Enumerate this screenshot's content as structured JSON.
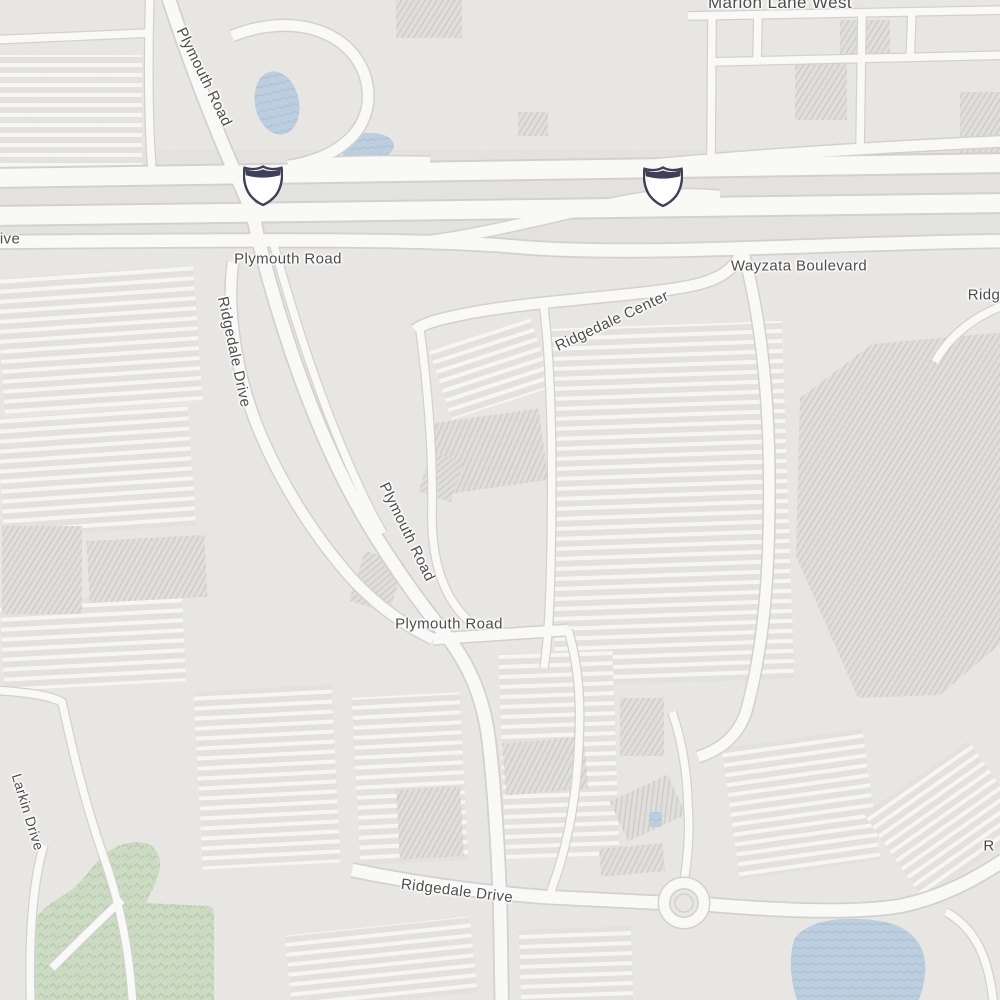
{
  "map": {
    "colors": {
      "background": "#e9e8e5",
      "road_fill": "#fbfbfa",
      "road_casing": "#d3d2cf",
      "freeway_corridor": "#e4e3e0",
      "water": "#bccfe0",
      "water_wave_line": "#aac2d6",
      "park": "#cddcc4",
      "park_tree": "#b6cba9",
      "building": "#e1e0dd",
      "building_hatch": "#cfcecb",
      "parking_base": "#e4e3e0",
      "parking_row": "#f8f8f6",
      "label": "#4d4d4d",
      "label_halo": "#ffffff",
      "shield_fill": "#ffffff",
      "shield_border": "#3f3f55"
    },
    "labels": [
      {
        "id": "marion-lane-west",
        "text": "Marion Lane West",
        "x": 780,
        "y": 3,
        "rotate": 0,
        "size": 17
      },
      {
        "id": "plymouth-road-nw",
        "text": "Plymouth Road",
        "x": 204,
        "y": 77,
        "rotate": 64,
        "size": 15
      },
      {
        "id": "plymouth-road-frontage",
        "text": "Plymouth Road",
        "x": 288,
        "y": 259,
        "rotate": 0,
        "size": 15
      },
      {
        "id": "wayzata-boulevard",
        "text": "Wayzata Boulevard",
        "x": 799,
        "y": 266,
        "rotate": 0,
        "size": 15
      },
      {
        "id": "ridgedale-center",
        "text": "Ridgedale Center",
        "x": 612,
        "y": 321,
        "rotate": -25,
        "size": 15
      },
      {
        "id": "ridgedale-drive-west",
        "text": "Ridgedale Drive",
        "x": 234,
        "y": 352,
        "rotate": 78,
        "size": 15
      },
      {
        "id": "plymouth-road-mid",
        "text": "Plymouth Road",
        "x": 407,
        "y": 532,
        "rotate": 64,
        "size": 15
      },
      {
        "id": "plymouth-road-south",
        "text": "Plymouth Road",
        "x": 449,
        "y": 624,
        "rotate": 0,
        "size": 15
      },
      {
        "id": "larkin-drive",
        "text": "Larkin Drive",
        "x": 28,
        "y": 812,
        "rotate": 73,
        "size": 14
      },
      {
        "id": "ridgedale-drive-south",
        "text": "Ridgedale Drive",
        "x": 457,
        "y": 891,
        "rotate": 7,
        "size": 15
      },
      {
        "id": "drive-clipped-west",
        "text": "ive",
        "x": 10,
        "y": 239,
        "rotate": 0,
        "size": 15
      },
      {
        "id": "ridgedale-clipped-east",
        "text": "Ridg",
        "x": 984,
        "y": 295,
        "rotate": 0,
        "size": 15
      },
      {
        "id": "road-clipped-southeast",
        "text": "R",
        "x": 989,
        "y": 846,
        "rotate": 0,
        "size": 15
      }
    ],
    "shields": [
      {
        "name": "interstate-shield",
        "x": 263,
        "y": 185
      },
      {
        "name": "interstate-shield",
        "x": 663,
        "y": 186
      }
    ]
  }
}
